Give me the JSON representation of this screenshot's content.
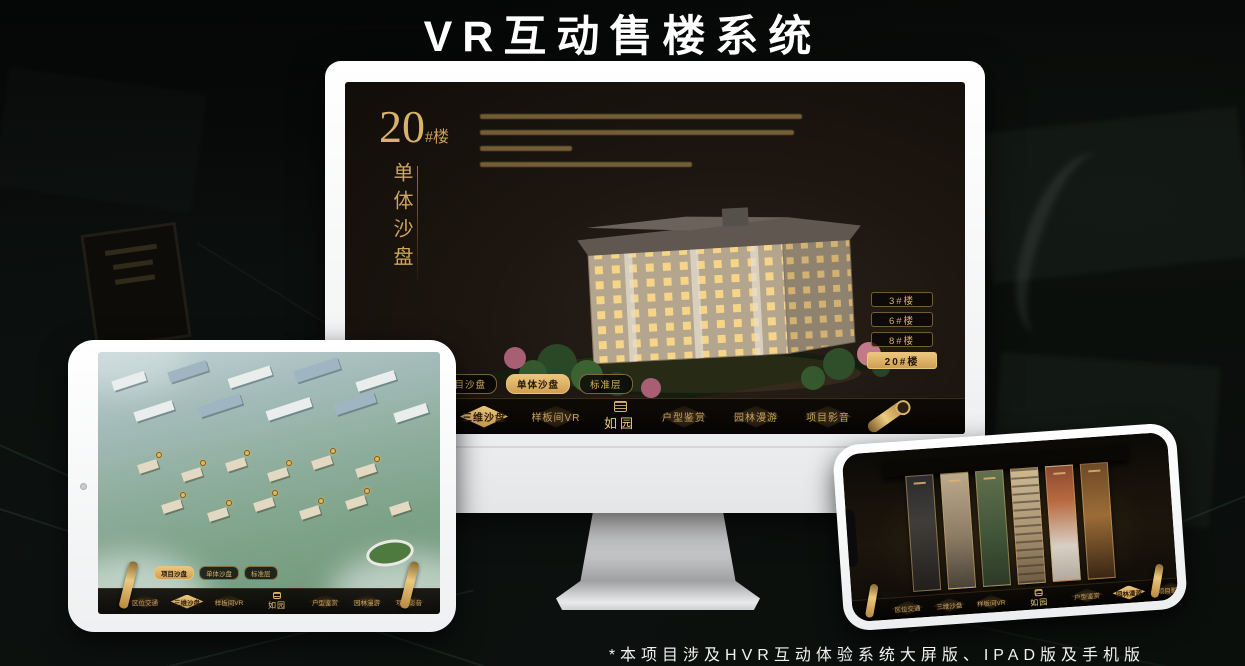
{
  "page": {
    "title": "VR互动售楼系统",
    "footnote": "*本项目涉及HVR互动体验系统大屏版、IPAD版及手机版"
  },
  "brand": {
    "logo": "如园",
    "gold": "#d8ae62"
  },
  "monitor": {
    "headline": {
      "number": "20",
      "suffix": "#楼",
      "subtitle": "单体沙盘"
    },
    "building_buttons": [
      {
        "label": "3#楼",
        "active": false
      },
      {
        "label": "6#楼",
        "active": false
      },
      {
        "label": "8#楼",
        "active": false
      },
      {
        "label": "20#楼",
        "active": true
      }
    ],
    "sub_tabs": [
      {
        "label": "项目沙盘",
        "active": false
      },
      {
        "label": "单体沙盘",
        "active": true
      },
      {
        "label": "标准层",
        "active": false
      }
    ],
    "nav_items": [
      {
        "label": "区位交通",
        "active": false
      },
      {
        "label": "三维沙盘",
        "active": true
      },
      {
        "label": "样板间VR",
        "active": false
      },
      {
        "label": "户型鉴赏",
        "active": false
      },
      {
        "label": "园林漫游",
        "active": false
      },
      {
        "label": "项目影音",
        "active": false
      }
    ],
    "logo": "如园"
  },
  "tablet": {
    "sub_tabs": [
      {
        "label": "项目沙盘",
        "active": true
      },
      {
        "label": "单体沙盘",
        "active": false
      },
      {
        "label": "标准层",
        "active": false
      }
    ],
    "nav_items": [
      {
        "label": "区位交通",
        "active": false
      },
      {
        "label": "三维沙盘",
        "active": true
      },
      {
        "label": "样板间VR",
        "active": false
      },
      {
        "label": "户型鉴赏",
        "active": false
      },
      {
        "label": "园林漫游",
        "active": false
      },
      {
        "label": "项目影音",
        "active": false
      }
    ],
    "logo": "如园"
  },
  "phone": {
    "nav_items": [
      {
        "label": "区位交通",
        "active": false
      },
      {
        "label": "三维沙盘",
        "active": false
      },
      {
        "label": "样板间VR",
        "active": false
      },
      {
        "label": "户型鉴赏",
        "active": false
      },
      {
        "label": "园林漫游",
        "active": true
      },
      {
        "label": "项目影音",
        "active": false
      }
    ],
    "logo": "如园"
  }
}
